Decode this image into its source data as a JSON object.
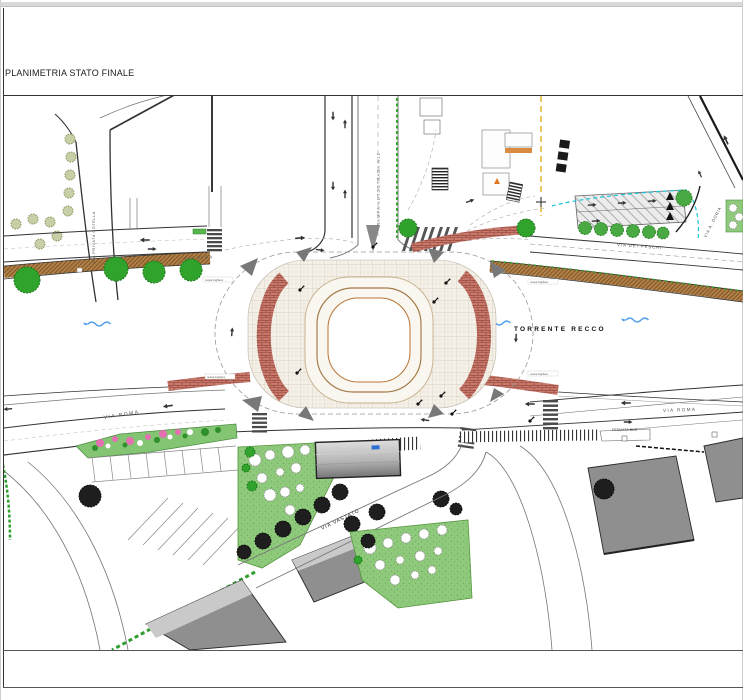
{
  "window": {
    "title_label": "PLANIMETRIA STATO FINALE"
  },
  "plan": {
    "streets": {
      "via_privata_cotella": "VIA PRIVATA COTELLA",
      "rampa_autostrada_a12": "RAMPA AUTOSTRADA A12",
      "via_pisa": "VIA PISA",
      "via_dei_peschi": "VIA DEI PESCHI",
      "via_a_doria": "VIA A. DORIA",
      "via_roma": "VIA ROMA",
      "via_vastato": "VIA VASTATO"
    },
    "river": {
      "name": "TORRENTE RECCO"
    },
    "annotations": {
      "fermata_bus": "FERMATA BUS",
      "railing_note": "nuova ringhiera"
    },
    "legend_colors": {
      "tree_green": "#2fa32b",
      "promenade_brown": "#b08049",
      "brick_red": "#c8796c",
      "water_blue": "#4a9df0",
      "park_green": "#8fca7c",
      "building_gray": "#8f8f8f",
      "caution_yellow": "#e8b83a",
      "cyan_line": "#18c5d8"
    }
  }
}
